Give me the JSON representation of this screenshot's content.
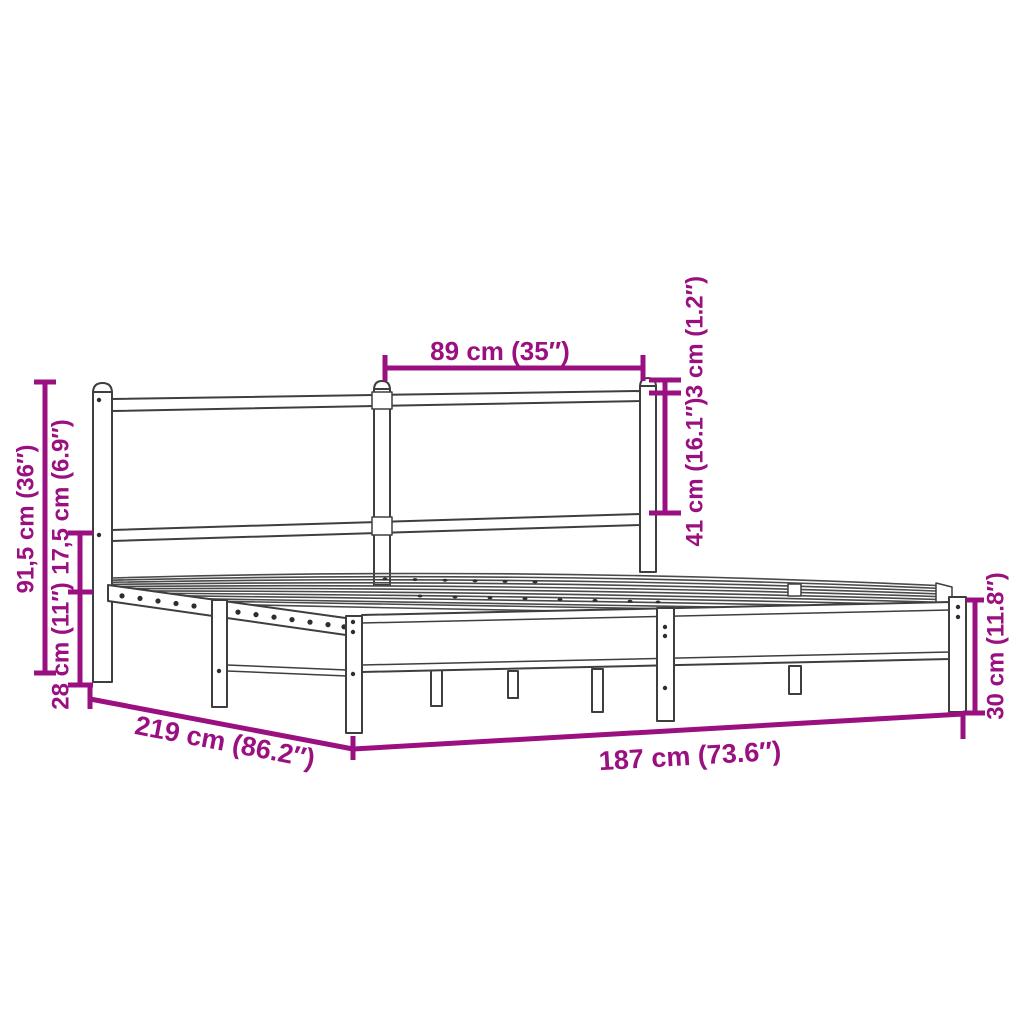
{
  "diagram": {
    "subject": "metal bed frame with headboard — dimension drawing",
    "colors": {
      "accent": "#9A1080",
      "outline": "#3E3E3E",
      "background": "#FFFFFF"
    },
    "labels": {
      "headboard_width": "89 cm (35″)",
      "headboard_top_gap": "3 cm (1.2″)",
      "headboard_panel_height": "41 cm (16.1″)",
      "overall_height": "91,5 cm (36″)",
      "rail_to_base_gap": "17,5 cm (6.9″)",
      "under_bed_clearance": "28 cm (11″)",
      "overall_length": "219 cm (86.2″)",
      "base_length": "187 cm (73.6″)",
      "footboard_height": "30 cm (11.8″)"
    }
  }
}
